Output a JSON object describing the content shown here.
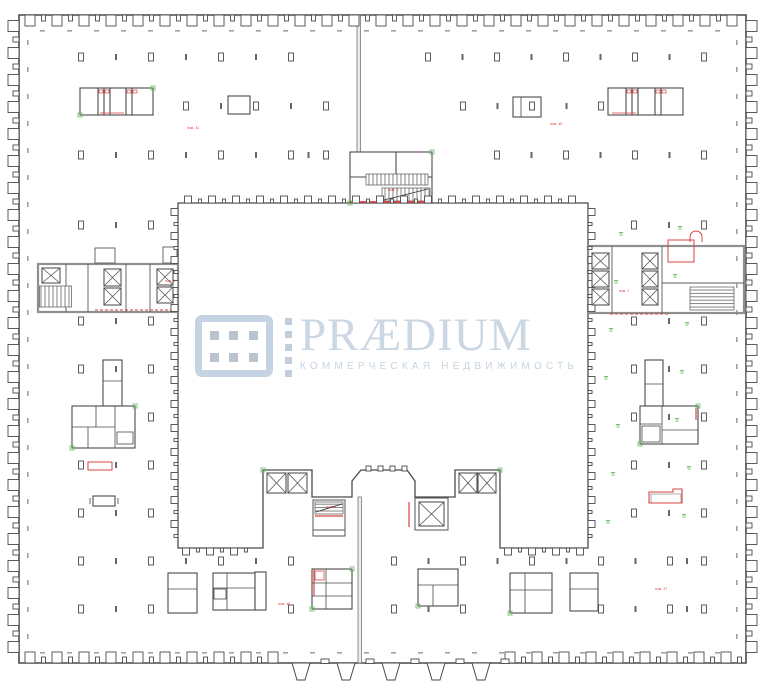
{
  "meta": {
    "title": "Office building floor plan",
    "type": "architectural-floor-plan",
    "watermark_owner": "PRAEDIUM"
  },
  "logo": {
    "brand": "PRÆDIUM",
    "tagline": "КОММЕРЧЕСКАЯ НЕДВИЖИМОСТЬ",
    "mark_color": "#c6d3e2",
    "dot_color": "#b9c4cf",
    "brand_color": "#cbd7e3",
    "tagline_color": "#c8d4e0"
  },
  "plan": {
    "colors": {
      "wall": "#4a4a4a",
      "partition": "#5a5a5a",
      "core_wall": "#8f8f8f",
      "red": "#d94343",
      "green": "#66bb5e",
      "dim": "#888888"
    },
    "red_room_labels": [
      {
        "text": "пом. 31",
        "x": 193,
        "y": 129
      },
      {
        "text": "пом. 40",
        "x": 556,
        "y": 125
      },
      {
        "text": "пом. 5",
        "x": 393,
        "y": 191
      },
      {
        "text": "пом. 1",
        "x": 170,
        "y": 282
      },
      {
        "text": "пом. 7",
        "x": 624,
        "y": 292
      },
      {
        "text": "пом. 9",
        "x": 331,
        "y": 508
      },
      {
        "text": "пом. 48",
        "x": 284,
        "y": 605
      },
      {
        "text": "пом. 37",
        "x": 661,
        "y": 590
      }
    ]
  }
}
